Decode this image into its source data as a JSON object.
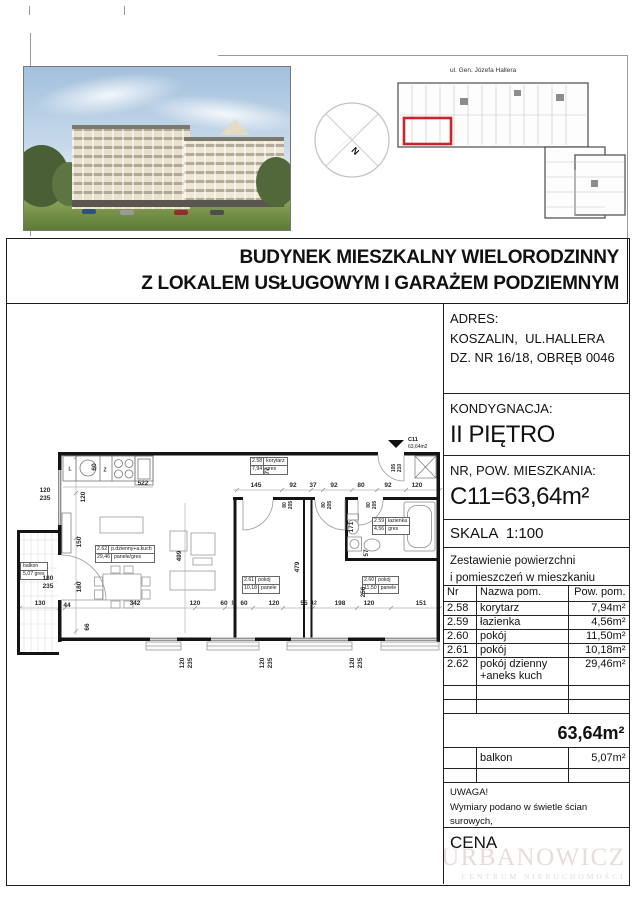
{
  "title": {
    "line1": "BUDYNEK MIESZKALNY WIELORODZINNY",
    "line2": "Z LOKALEM USŁUGOWYM I GARAŻEM PODZIEMNYM"
  },
  "overview": {
    "street": "ul. Gen. Józefa Hallera",
    "compass_n": "N"
  },
  "info": {
    "adres_heading": "ADRES:",
    "adres_line1": "KOSZALIN,  UL.HALLERA",
    "adres_line2": "DZ. NR 16/18, OBRĘB 0046",
    "kond_heading": "KONDYGNACJA:",
    "kond_value": "II PIĘTRO",
    "nr_heading": "NR, POW. MIESZKANIA:",
    "nr_value": "C11=63,64m²",
    "skala": "SKALA  1:100"
  },
  "table": {
    "caption1": "Zestawienie powierzchni",
    "caption2": "i pomieszczeń w mieszkaniu",
    "col_nr": "Nr",
    "col_name": "Nazwa pom.",
    "col_area": "Pow. pom.",
    "rows": [
      {
        "nr": "2.58",
        "name": "korytarz",
        "area": "7,94m²"
      },
      {
        "nr": "2.59",
        "name": "łazienka",
        "area": "4,56m²"
      },
      {
        "nr": "2.60",
        "name": "pokój",
        "area": "11,50m²"
      },
      {
        "nr": "2.61",
        "name": "pokój",
        "area": "10,18m²"
      },
      {
        "nr": "2.62",
        "name": "pokój dzienny +aneks kuch",
        "area": "29,46m²"
      }
    ],
    "total": "63,64m²",
    "balkon_name": "balkon",
    "balkon_area": "5,07m²"
  },
  "notes": {
    "uwaga_heading": "UWAGA!",
    "uwaga1": "Wymiary podano w świetle ścian surowych,",
    "uwaga2": "rzeczywiste wymiary mogą ulec",
    "uwaga3": "nieznacznym korektom.",
    "cena": "CENA"
  },
  "logo": {
    "name": "URBANOWICZ",
    "subtitle": "CENTRUM NIERUCHOMOŚCI"
  },
  "plan": {
    "marker_code": "C11",
    "marker_area": "63,64m2",
    "rooms": {
      "korytarz": {
        "nr": "2.58",
        "name": "korytarz",
        "area": "7,94",
        "floor": "gres"
      },
      "lazienka": {
        "nr": "2.59",
        "name": "łazienka",
        "area": "4,56",
        "floor": "gres"
      },
      "pokoj61": {
        "nr": "2.61",
        "name": "pokój",
        "area": "10,18",
        "floor": "panele"
      },
      "pokoj60": {
        "nr": "2.60",
        "name": "pokój",
        "area": "11,50",
        "floor": "panele"
      },
      "dzienny": {
        "nr": "2.62",
        "name": "p.dzienny+a.kuch",
        "area": "29,46",
        "floor": "panele/gres"
      },
      "balkon_name": "balkon",
      "balkon_area": "5,07 gres"
    },
    "dims": {
      "top": [
        "145",
        "92",
        "37",
        "92",
        "80",
        "92",
        "120"
      ],
      "kitchen_w": "522",
      "kitchen_d": "60",
      "hall77": "77",
      "win_left": [
        "120",
        "235"
      ],
      "door_balkon": [
        "180",
        "235"
      ],
      "v_living": [
        "120",
        "150",
        "180",
        "66"
      ],
      "v499": "499",
      "v479": "479",
      "v256": "256",
      "v171": "171",
      "v57": "57",
      "bottom": [
        "130",
        "44",
        "342",
        "120",
        "60",
        "12",
        "60",
        "120",
        "55",
        "12",
        "198",
        "120",
        "151"
      ],
      "win_bottom": [
        "120",
        "235"
      ],
      "entry_door": [
        "105",
        "210"
      ],
      "inner_door": [
        "80",
        "205"
      ],
      "fridge": "L",
      "sink": "Z"
    }
  },
  "colors": {
    "highlight_red": "#c9252b",
    "wall_black": "#141414",
    "logo_pink": "#e8dcda"
  }
}
